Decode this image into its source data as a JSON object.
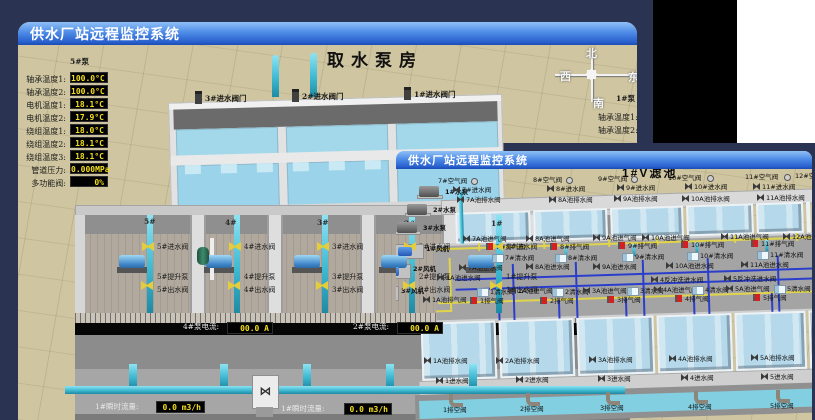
{
  "desktop": {
    "bg_navy": "#2a3452",
    "bg_black": "#000000",
    "bg_white": "#ffffff"
  },
  "back_window": {
    "titlebar": "供水厂站远程监控系统",
    "scene_title": "取水泵房",
    "pump_panel": {
      "pump_label": "5#泵",
      "rows": [
        {
          "label": "轴承温度1:",
          "value": "100.0°C"
        },
        {
          "label": "轴承温度2:",
          "value": "100.0°C"
        },
        {
          "label": "电机温度1:",
          "value": "18.1°C"
        },
        {
          "label": "电机温度2:",
          "value": "17.9°C"
        },
        {
          "label": "绕组温度1:",
          "value": "18.0°C"
        },
        {
          "label": "绕组温度2:",
          "value": "18.1°C"
        },
        {
          "label": "绕组温度3:",
          "value": "18.1°C"
        },
        {
          "label": "管道压力:",
          "value": "0.000MPa"
        },
        {
          "label": "多功能阀:",
          "value": "0%"
        }
      ]
    },
    "intake_valve_labels": [
      {
        "t": "3#进水阀门",
        "x": 187,
        "y": 73
      },
      {
        "t": "2#进水阀门",
        "x": 284,
        "y": 71
      },
      {
        "t": "1#进水阀门",
        "x": 396,
        "y": 69
      }
    ],
    "compass": {
      "n": "北",
      "w": "西",
      "s": "南",
      "e": "东"
    },
    "right_panel": {
      "pump_label": "1#泵",
      "labels": [
        {
          "t": "轴承温度1:",
          "x": 580,
          "y": 90
        },
        {
          "t": "轴承温度2:",
          "x": 580,
          "y": 103
        }
      ]
    },
    "bay_numbers": [
      {
        "t": "5#",
        "x": 126,
        "y": 196
      },
      {
        "t": "4#",
        "x": 207,
        "y": 197
      },
      {
        "t": "3#",
        "x": 299,
        "y": 197
      },
      {
        "t": "2#",
        "x": 386,
        "y": 198
      },
      {
        "t": "1#",
        "x": 473,
        "y": 198
      }
    ],
    "pump_bays": [
      {
        "x": 132,
        "valve_in": "5#进水阀",
        "pump": "5#提升泵",
        "valve_out": "5#出水阀"
      },
      {
        "x": 219,
        "valve_in": "4#进水阀",
        "pump": "4#提升泵",
        "valve_out": "4#出水阀"
      },
      {
        "x": 307,
        "valve_in": "3#进水阀",
        "pump": "3#提升泵",
        "valve_out": "3#出水阀"
      },
      {
        "x": 394,
        "valve_in": "2#进水阀",
        "pump": "2#提升泵",
        "valve_out": "2#出水阀"
      },
      {
        "x": 481,
        "valve_in": "1#进水阀",
        "pump": "1#提升泵",
        "valve_out": "1#出水阀"
      }
    ],
    "readouts": [
      {
        "label": "4#泵电流:",
        "value": "00.0 A",
        "lx": 165,
        "ly": 301,
        "bx": 209,
        "by": 300,
        "bw": 46
      },
      {
        "label": "2#泵电流:",
        "value": "00.0 A",
        "lx": 335,
        "ly": 301,
        "bx": 379,
        "by": 300,
        "bw": 46
      },
      {
        "label": "1#瞬时流量:",
        "value": "0.0 m3/h",
        "lx": 77,
        "ly": 381,
        "bx": 138,
        "by": 379,
        "bw": 49
      },
      {
        "label": "1#瞬时流量:",
        "value": "0.0 m3/h",
        "lx": 263,
        "ly": 383,
        "bx": 326,
        "by": 381,
        "bw": 48
      }
    ]
  },
  "front_window": {
    "titlebar": "供水厂站远程监控系统",
    "scene_title": "1#V滤池",
    "equipment": [
      {
        "t": "1#水泵",
        "x": 49,
        "y": 38,
        "type": "pump"
      },
      {
        "t": "2#水泵",
        "x": 37,
        "y": 56,
        "type": "pump"
      },
      {
        "t": "3#水泵",
        "x": 27,
        "y": 74,
        "type": "pump"
      },
      {
        "t": "1#风机",
        "x": 30,
        "y": 95,
        "type": "fan"
      },
      {
        "t": "2#风机",
        "x": 17,
        "y": 115,
        "type": "fan"
      },
      {
        "t": "3#风机",
        "x": 5,
        "y": 137,
        "type": "fan"
      }
    ],
    "valve_labels": [
      {
        "t": "7#空气阀",
        "x": 42,
        "y": 27,
        "ic": "air"
      },
      {
        "t": "8#空气阀",
        "x": 137,
        "y": 26,
        "ic": "air"
      },
      {
        "t": "9#空气阀",
        "x": 202,
        "y": 25,
        "ic": "air"
      },
      {
        "t": "10#空气阀",
        "x": 272,
        "y": 24,
        "ic": "air"
      },
      {
        "t": "11#空气阀",
        "x": 349,
        "y": 23,
        "ic": "air"
      },
      {
        "t": "12#空气阀",
        "x": 399,
        "y": 22,
        "ic": "air"
      },
      {
        "t": "7#进水阀",
        "x": 66,
        "y": 36,
        "ic": "vd"
      },
      {
        "t": "8#进水阀",
        "x": 160,
        "y": 35,
        "ic": "vd"
      },
      {
        "t": "9#进水阀",
        "x": 230,
        "y": 34,
        "ic": "vd"
      },
      {
        "t": "10#进水阀",
        "x": 298,
        "y": 33,
        "ic": "vd"
      },
      {
        "t": "11#进水阀",
        "x": 366,
        "y": 33,
        "ic": "vd"
      },
      {
        "t": "7A池排水阀",
        "x": 70,
        "y": 46,
        "ic": "vd"
      },
      {
        "t": "8A池排水阀",
        "x": 162,
        "y": 46,
        "ic": "vd"
      },
      {
        "t": "9A池排水阀",
        "x": 227,
        "y": 45,
        "ic": "vd"
      },
      {
        "t": "10A池排水阀",
        "x": 295,
        "y": 45,
        "ic": "vd"
      },
      {
        "t": "11A池排水阀",
        "x": 370,
        "y": 44,
        "ic": "vd"
      },
      {
        "t": "7A池进气阀",
        "x": 76,
        "y": 85,
        "ic": "vd"
      },
      {
        "t": "8A池进气阀",
        "x": 139,
        "y": 85,
        "ic": "vd"
      },
      {
        "t": "9A池进气阀",
        "x": 206,
        "y": 84,
        "ic": "vd"
      },
      {
        "t": "10A池进气阀",
        "x": 255,
        "y": 84,
        "ic": "vd"
      },
      {
        "t": "11A池进气阀",
        "x": 334,
        "y": 83,
        "ic": "vd"
      },
      {
        "t": "12A池进气阀",
        "x": 396,
        "y": 83,
        "ic": "vd"
      },
      {
        "t": "7#排气阀",
        "x": 100,
        "y": 93,
        "ic": "red"
      },
      {
        "t": "8#排气阀",
        "x": 164,
        "y": 93,
        "ic": "red"
      },
      {
        "t": "9#排气阀",
        "x": 232,
        "y": 92,
        "ic": "red"
      },
      {
        "t": "10#排气阀",
        "x": 295,
        "y": 91,
        "ic": "red"
      },
      {
        "t": "11#排气阀",
        "x": 365,
        "y": 90,
        "ic": "red"
      },
      {
        "t": "7#清水阀",
        "x": 109,
        "y": 104,
        "ic": "tank"
      },
      {
        "t": "8#清水阀",
        "x": 172,
        "y": 104,
        "ic": "tank"
      },
      {
        "t": "9#清水阀",
        "x": 239,
        "y": 103,
        "ic": "tank"
      },
      {
        "t": "10#清水阀",
        "x": 304,
        "y": 102,
        "ic": "tank"
      },
      {
        "t": "11#清水阀",
        "x": 374,
        "y": 101,
        "ic": "tank"
      },
      {
        "t": "7A池进水阀",
        "x": 72,
        "y": 114,
        "ic": "vd"
      },
      {
        "t": "8A池进水阀",
        "x": 139,
        "y": 113,
        "ic": "vd"
      },
      {
        "t": "9A池进水阀",
        "x": 206,
        "y": 113,
        "ic": "vd"
      },
      {
        "t": "10A池进水阀",
        "x": 279,
        "y": 112,
        "ic": "vd"
      },
      {
        "t": "11A池进水阀",
        "x": 354,
        "y": 111,
        "ic": "vd"
      },
      {
        "t": "1A池进水阀",
        "x": 50,
        "y": 124,
        "ic": "vd"
      },
      {
        "t": "4反冲洗进水阀",
        "x": 264,
        "y": 126,
        "ic": "vd"
      },
      {
        "t": "5反冲洗进水阀",
        "x": 337,
        "y": 125,
        "ic": "vd"
      },
      {
        "t": "1清水阀",
        "x": 94,
        "y": 138,
        "ic": "tank"
      },
      {
        "t": "2A池进气阀",
        "x": 122,
        "y": 137,
        "ic": "vd"
      },
      {
        "t": "2清水阀",
        "x": 169,
        "y": 138,
        "ic": "tank"
      },
      {
        "t": "3A池进气阀",
        "x": 196,
        "y": 137,
        "ic": "vd"
      },
      {
        "t": "3清水阀",
        "x": 244,
        "y": 137,
        "ic": "tank"
      },
      {
        "t": "4A池进气阀",
        "x": 267,
        "y": 136,
        "ic": "vd"
      },
      {
        "t": "4清水阀",
        "x": 309,
        "y": 136,
        "ic": "tank"
      },
      {
        "t": "5A池进气阀",
        "x": 339,
        "y": 135,
        "ic": "vd"
      },
      {
        "t": "5清水阀",
        "x": 391,
        "y": 135,
        "ic": "tank"
      },
      {
        "t": "1A池排气阀",
        "x": 36,
        "y": 146,
        "ic": "vd"
      },
      {
        "t": "1排气阀",
        "x": 84,
        "y": 147,
        "ic": "red"
      },
      {
        "t": "2排气阀",
        "x": 154,
        "y": 147,
        "ic": "red"
      },
      {
        "t": "3排气阀",
        "x": 221,
        "y": 146,
        "ic": "red"
      },
      {
        "t": "4排气阀",
        "x": 289,
        "y": 145,
        "ic": "red"
      },
      {
        "t": "5排气阀",
        "x": 367,
        "y": 144,
        "ic": "red"
      },
      {
        "t": "1A池排水阀",
        "x": 37,
        "y": 207,
        "ic": "vd"
      },
      {
        "t": "2A池排水阀",
        "x": 109,
        "y": 207,
        "ic": "vd"
      },
      {
        "t": "3A池排水阀",
        "x": 202,
        "y": 206,
        "ic": "vd"
      },
      {
        "t": "4A池排水阀",
        "x": 282,
        "y": 205,
        "ic": "vd"
      },
      {
        "t": "5A池排水阀",
        "x": 364,
        "y": 204,
        "ic": "vd"
      },
      {
        "t": "1进水阀",
        "x": 49,
        "y": 227,
        "ic": "vd"
      },
      {
        "t": "2进水阀",
        "x": 129,
        "y": 226,
        "ic": "vd"
      },
      {
        "t": "3进水阀",
        "x": 211,
        "y": 225,
        "ic": "vd"
      },
      {
        "t": "4进水阀",
        "x": 294,
        "y": 224,
        "ic": "vd"
      },
      {
        "t": "5进水阀",
        "x": 374,
        "y": 223,
        "ic": "vd"
      },
      {
        "t": "1排空阀",
        "x": 47,
        "y": 256,
        "ic": "elbow"
      },
      {
        "t": "2排空阀",
        "x": 124,
        "y": 255,
        "ic": "elbow"
      },
      {
        "t": "3排空阀",
        "x": 204,
        "y": 254,
        "ic": "elbow"
      },
      {
        "t": "4排空阀",
        "x": 292,
        "y": 253,
        "ic": "elbow"
      },
      {
        "t": "5排空阀",
        "x": 374,
        "y": 252,
        "ic": "elbow"
      }
    ]
  }
}
